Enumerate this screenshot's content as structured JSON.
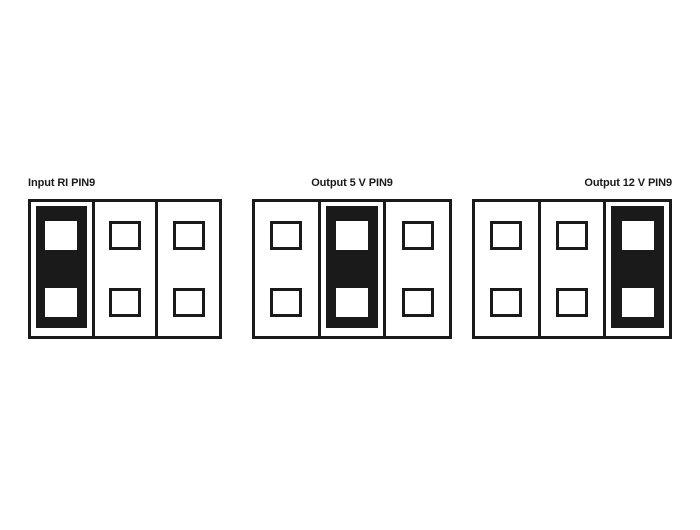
{
  "colors": {
    "ink": "#1a1a1a",
    "paper": "#ffffff"
  },
  "diagrams": [
    {
      "label": "Input RI PIN9",
      "active_column": 0,
      "columns": 3,
      "pads_per_column": 2
    },
    {
      "label": "Output 5 V PIN9",
      "active_column": 1,
      "columns": 3,
      "pads_per_column": 2
    },
    {
      "label": "Output 12 V PIN9",
      "active_column": 2,
      "columns": 3,
      "pads_per_column": 2
    }
  ]
}
